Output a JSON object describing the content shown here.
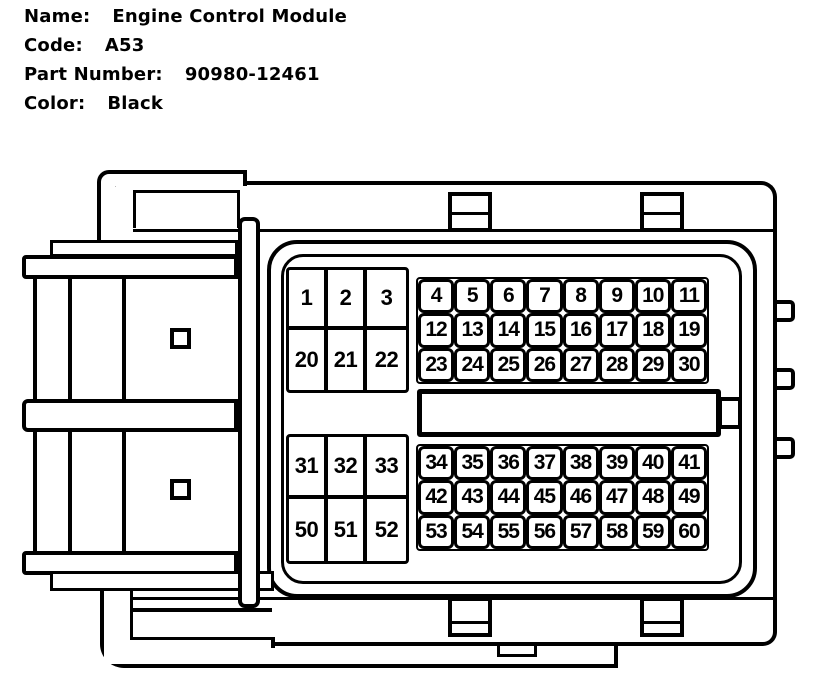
{
  "header": {
    "fields": [
      {
        "label": "Name:",
        "value": "Engine Control Module"
      },
      {
        "label": "Code:",
        "value": "A53"
      },
      {
        "label": "Part Number:",
        "value": "90980-12461"
      },
      {
        "label": "Color:",
        "value": "Black"
      }
    ]
  },
  "connector": {
    "type": "60-pin ECM connector, face view line drawing",
    "line_color": "#000000",
    "background_color": "#ffffff",
    "pin_blocks": {
      "top_left": {
        "rows": [
          [
            "1",
            "2",
            "3"
          ],
          [
            "20",
            "21",
            "22"
          ]
        ]
      },
      "top_right": {
        "rows": [
          [
            "4",
            "5",
            "6",
            "7",
            "8",
            "9",
            "10",
            "11"
          ],
          [
            "12",
            "13",
            "14",
            "15",
            "16",
            "17",
            "18",
            "19"
          ],
          [
            "23",
            "24",
            "25",
            "26",
            "27",
            "28",
            "29",
            "30"
          ]
        ]
      },
      "bottom_left": {
        "rows": [
          [
            "31",
            "32",
            "33"
          ],
          [
            "50",
            "51",
            "52"
          ]
        ]
      },
      "bottom_right": {
        "rows": [
          [
            "34",
            "35",
            "36",
            "37",
            "38",
            "39",
            "40",
            "41"
          ],
          [
            "42",
            "43",
            "44",
            "45",
            "46",
            "47",
            "48",
            "49"
          ],
          [
            "53",
            "54",
            "55",
            "56",
            "57",
            "58",
            "59",
            "60"
          ]
        ]
      }
    }
  }
}
